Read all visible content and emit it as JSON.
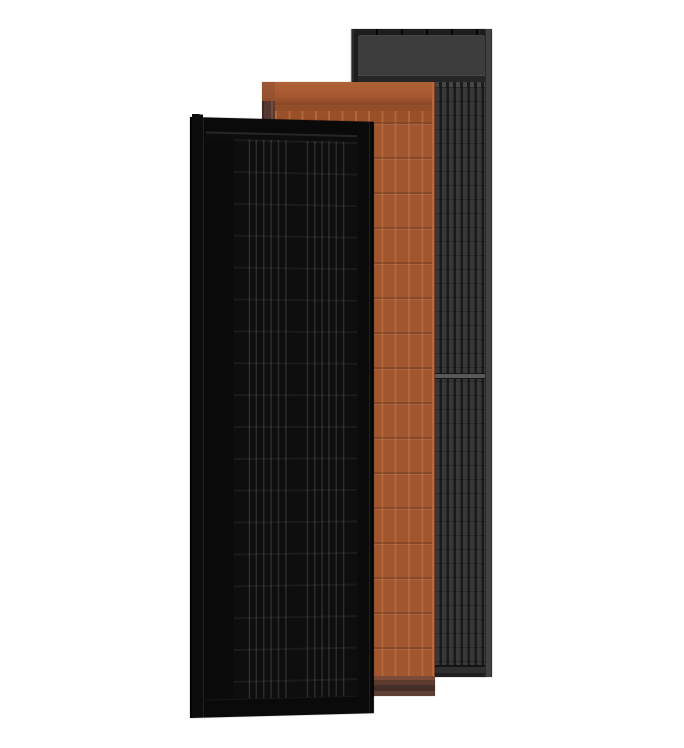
{
  "canvas": {
    "width": 684,
    "height": 748,
    "background": "#ffffff"
  },
  "subject": "three overlapping solar roof panels",
  "panels": [
    {
      "name": "black solar panel",
      "stack": "front"
    },
    {
      "name": "terracotta solar panel",
      "stack": "middle"
    },
    {
      "name": "dark gray solar panel",
      "stack": "back"
    }
  ],
  "colors": {
    "canvas-bg": "#ffffff",
    "black-body": "#0b0b0b",
    "black-line": "#2c2c2c",
    "black-frame": "#020202",
    "black-highlight": "#262626",
    "terra-body": "#a2562f",
    "terra-rib": "#b2663c",
    "terra-side": "#553931",
    "terra-seam": "#8a4826",
    "terra-bottom": "#5c3b2e",
    "gray-body": "#242424",
    "gray-stripe": "#383838",
    "gray-header": "#3d3d3d",
    "gray-frame": "#1d1d1d",
    "gray-edge": "#414141"
  }
}
